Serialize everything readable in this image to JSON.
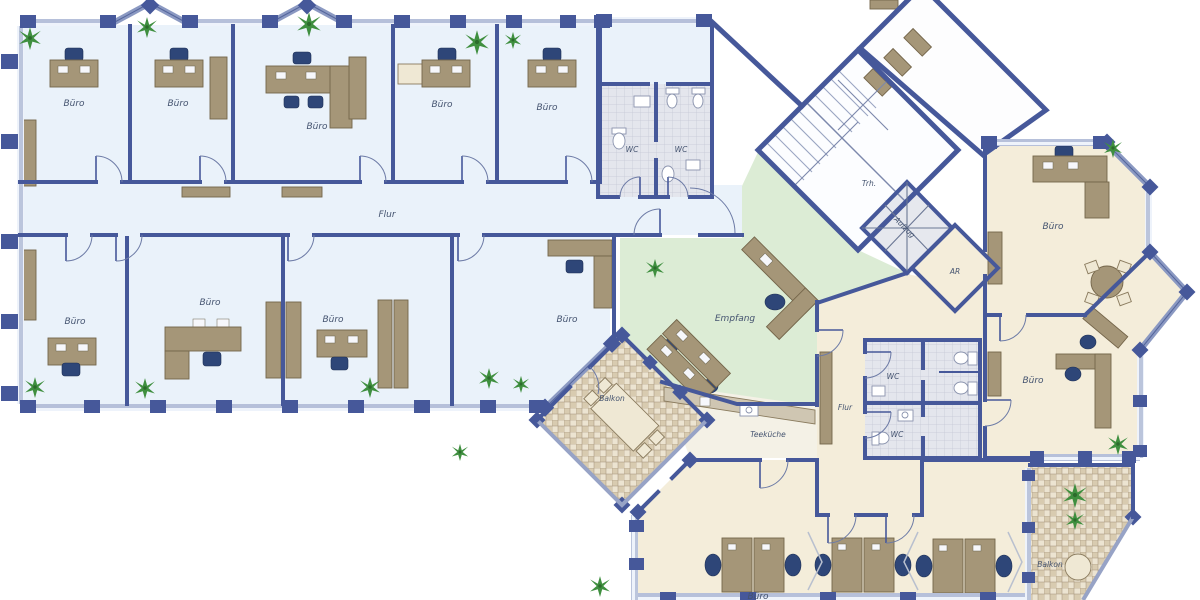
{
  "document": {
    "type": "architectural-floor-plan",
    "description": "Office building floor plan with west office wing, central reception, stair core and east wing with seminar room and balconies"
  },
  "strings": {
    "buero": "Büro",
    "flur": "Flur",
    "wc": "WC",
    "trh": "Trh.",
    "aufzug": "Aufzug",
    "ar": "AR",
    "empfang": "Empfang",
    "teekueche": "Teeküche",
    "balkon": "Balkon"
  },
  "rooms": [
    {
      "label": "Büro",
      "area": "west-wing-top-row",
      "count": 5
    },
    {
      "label": "Büro",
      "area": "west-wing-bottom-row",
      "count": 4
    },
    {
      "label": "Flur",
      "area": "west-wing-corridor",
      "count": 1
    },
    {
      "label": "WC",
      "area": "north-core",
      "count": 2
    },
    {
      "label": "Trh.",
      "area": "stairwell",
      "count": 1
    },
    {
      "label": "Aufzug",
      "area": "elevator",
      "count": 1
    },
    {
      "label": "AR",
      "area": "storage-room",
      "count": 1
    },
    {
      "label": "Empfang",
      "area": "reception",
      "count": 1
    },
    {
      "label": "Büro",
      "area": "east-wing",
      "count": 2
    },
    {
      "label": "WC",
      "area": "east-core",
      "count": 2
    },
    {
      "label": "Flur",
      "area": "east-corridor",
      "count": 1
    },
    {
      "label": "Teeküche",
      "area": "kitchenette",
      "count": 1
    },
    {
      "label": "Balkon",
      "area": "west-balcony",
      "count": 1
    },
    {
      "label": "Balkon",
      "area": "east-balcony",
      "count": 1
    },
    {
      "label": "Büro",
      "area": "seminar-room-south",
      "count": 1
    }
  ],
  "colors": {
    "wall": "#46589a",
    "floor_west_wing": "#eaf2fa",
    "floor_east_wing": "#f4edda",
    "floor_reception": "#dcecd5",
    "wc_tile": "#e4e6ed",
    "balcony_tile": "#ede5d2",
    "desk": "#a59678",
    "chair": "#2e4678",
    "plant": "#3f8f3f"
  }
}
